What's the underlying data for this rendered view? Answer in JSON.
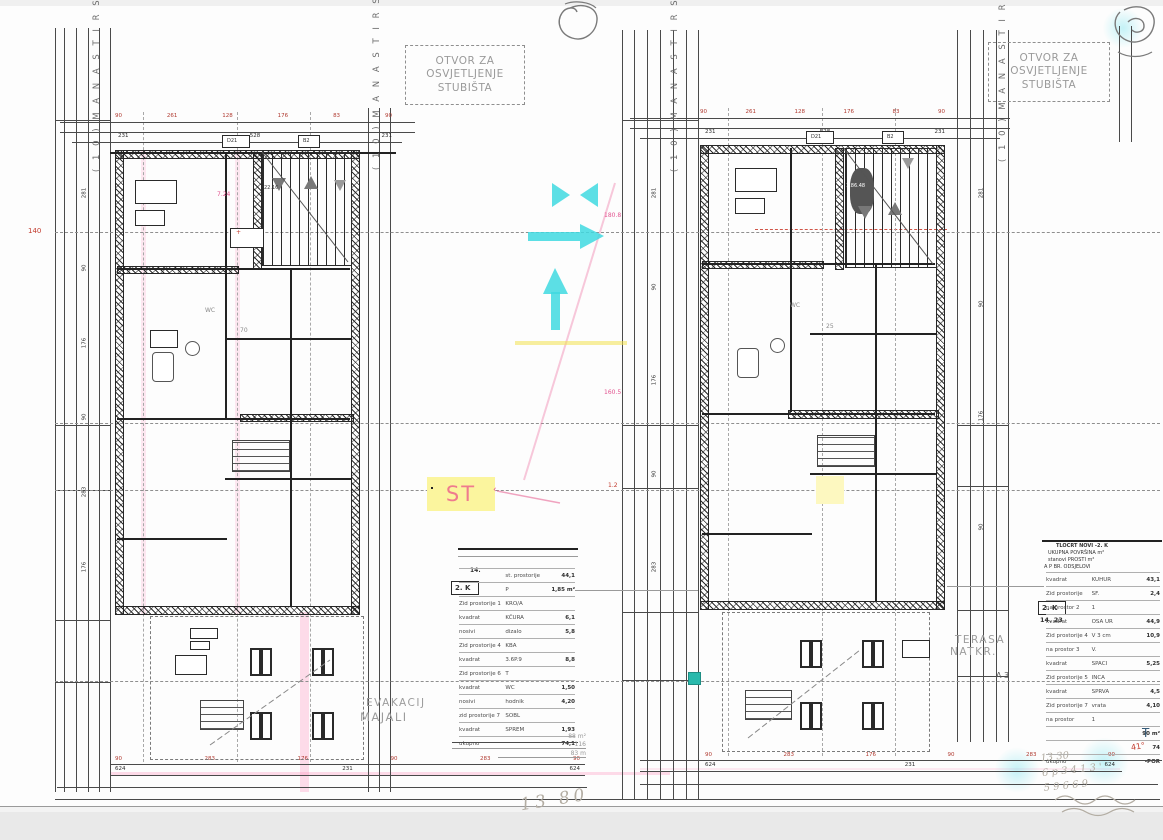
{
  "annotations": {
    "skylight": [
      "OTVOR ZA",
      "OSVJETLJENJE",
      "STUBIŠTA"
    ],
    "st": "ST",
    "evac": [
      "EVAKACIJ",
      "MAJALI"
    ],
    "terrace": [
      "TERASA",
      "NATKR."
    ],
    "marker3": "Λ 3",
    "level": "140",
    "wc": "WC",
    "street": "( 1 0 )  M A N A S T I R S K A",
    "room_num_left": "70",
    "room_num_right": "25",
    "pink": {
      "p1": "7.24",
      "p2": "180.8",
      "p3": "160.5",
      "p4": "1.2"
    },
    "plus": "+",
    "leader_tick": "‹",
    "stair_tag_left": "22.16",
    "stair_tag_right": "1.86.48"
  },
  "door_tags": [
    "D21",
    "B2"
  ],
  "dims": {
    "top_left": [
      "90",
      "261",
      "128",
      "176",
      "83",
      "90"
    ],
    "top_left2": [
      "231",
      "528",
      "231"
    ],
    "top_right": [
      "90",
      "261",
      "128",
      "176",
      "83",
      "90"
    ],
    "top_right2": [
      "231",
      "528",
      "231"
    ],
    "bottom_left": [
      "90",
      "283",
      "176",
      "90",
      "283",
      "90"
    ],
    "bottom_left2": [
      "624",
      "231",
      "624"
    ],
    "bottom_right": [
      "90",
      "283",
      "176",
      "90",
      "283",
      "90"
    ],
    "bottom_right2": [
      "624",
      "231",
      "624"
    ],
    "left_margin": [
      "281",
      "90",
      "176",
      "90",
      "283",
      "176"
    ],
    "mid_margin": [
      "281",
      "90",
      "176",
      "90",
      "283"
    ],
    "right_margin": [
      "281",
      "90",
      "176",
      "90"
    ]
  },
  "tables": {
    "left": {
      "top_note": "14.",
      "floor_tag": "2. K",
      "rows": [
        {
          "a": "",
          "b": "st. prostorije",
          "c": "44,1"
        },
        {
          "a": "",
          "b": "P",
          "c": "1,85 m²"
        },
        {
          "a": "Zid prostorije 1",
          "b": "KRO/A",
          "c": ""
        },
        {
          "a": "kvadrat",
          "b": "KČURA",
          "c": "6,1"
        },
        {
          "a": "nosivi",
          "b": "dizalo",
          "c": "5,8"
        },
        {
          "a": "Zid prostorije 4",
          "b": "KBA",
          "c": ""
        },
        {
          "a": "kvadrat",
          "b": "3.6P.9",
          "c": "8,8"
        },
        {
          "a": "Zid prostorije 6",
          "b": "T",
          "c": ""
        },
        {
          "a": "kvadrat",
          "b": "WC",
          "c": "1,50"
        },
        {
          "a": "nosivi",
          "b": "hodnik",
          "c": "4,20"
        },
        {
          "a": "zid prostorije 7",
          "b": "SOBL",
          "c": ""
        },
        {
          "a": "kvadrat",
          "b": "SPREM",
          "c": "1,93"
        },
        {
          "a": "ukupno",
          "b": "",
          "c": "74,1"
        }
      ]
    },
    "right": {
      "header1": "TLOCRT NOVI -2. K",
      "header2": "UKUPNA POVRŠINA m²",
      "header3": "stanovi   PROSTI   m²",
      "header4": "A  P     BR. ODSJELOVI",
      "floor_tag": "2. K",
      "sub_tag": "14. 23",
      "rows": [
        {
          "a": "kvadrat",
          "b": "KUHUR",
          "c": "43,1"
        },
        {
          "a": "Zid prostorije",
          "b": "SF.",
          "c": "2,4"
        },
        {
          "a": "na prostor 2",
          "b": "1",
          "c": ""
        },
        {
          "a": "kvadrat",
          "b": "OSA UR",
          "c": "44,9"
        },
        {
          "a": "Zid prostorije 4",
          "b": "V 3 cm",
          "c": "10,9"
        },
        {
          "a": "na prostor 3",
          "b": "V.",
          "c": ""
        },
        {
          "a": "kvadrat",
          "b": "SPACI",
          "c": "5,25"
        },
        {
          "a": "Zid prostorije 5",
          "b": "INCA",
          "c": ""
        },
        {
          "a": "kvadrat",
          "b": "SPRVA",
          "c": "4,5"
        },
        {
          "a": "Zid prostorije 7",
          "b": "vrata",
          "c": "4,10"
        },
        {
          "a": "na prostor",
          "b": "1",
          "c": ""
        },
        {
          "a": "",
          "b": "",
          "c": "90 m²"
        },
        {
          "a": "",
          "b": "",
          "c": "74"
        },
        {
          "a": "ukupno",
          "b": "",
          "c": "-POR"
        }
      ],
      "corner_t": "T",
      "corner_note": "41°"
    }
  },
  "handwriting": {
    "big": "13 80",
    "notes": [
      "88 m²",
      "116",
      "83 m"
    ],
    "right_lines": [
      "13 30",
      "6 p 3 4  1 3 '",
      "5 9   6 6 9"
    ]
  }
}
